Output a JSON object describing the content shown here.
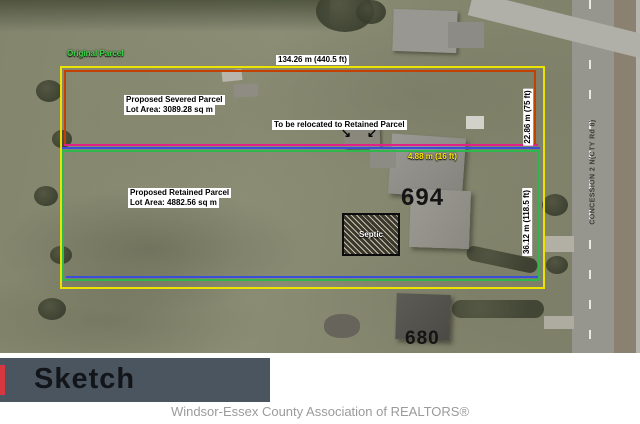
{
  "map": {
    "labels": {
      "original_parcel": "Original Parcel",
      "top_measure": "134.26 m (440.5 ft)",
      "severed_title": "Proposed Severed Parcel",
      "severed_area": "Lot Area: 3089.28 sq m",
      "relocate_note": "To be relocated to Retained Parcel",
      "gap_measure": "4.88 m (16 ft)",
      "house_694": "694",
      "septic": "Septic",
      "retained_title": "Proposed Retained Parcel",
      "retained_area": "Lot Area: 4882.56 sq m",
      "side_measure_severed": "22.86 m (75 ft)",
      "side_measure_retained": "36.12 m (118.5 ft)",
      "road_name": "CONCESSION 2 N(CTY Rd 8)",
      "house_680": "680",
      "arrow_glyph_left": "↘",
      "arrow_glyph_right": "↙"
    },
    "colors": {
      "original_outline": "#ece400",
      "severed_outline": "#c24000",
      "division_line": "#e0218a",
      "retained_outline_blue": "#3a4fd8",
      "retained_outline_green": "#2db84d",
      "original_label_text": "#3ed44a",
      "gap_measure_text": "#ffe607",
      "banner_background": "#4b555f",
      "banner_accent": "#d8373f"
    }
  },
  "banner": {
    "label": "Sketch"
  },
  "footer": {
    "text": "Windsor-Essex County Association of REALTORS®"
  }
}
